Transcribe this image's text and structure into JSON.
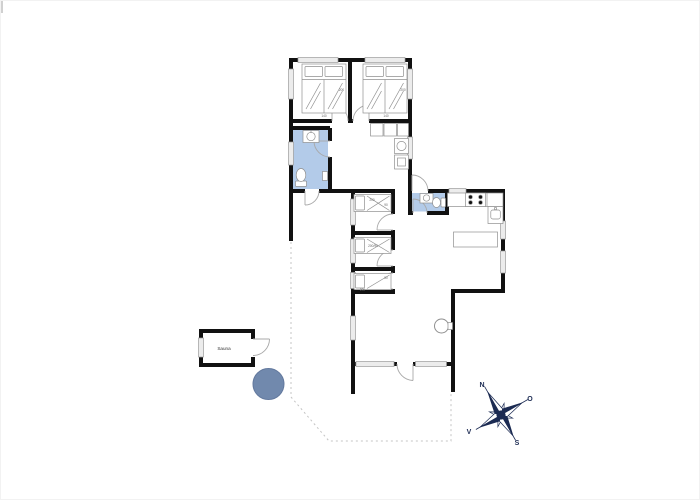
{
  "canvas": {
    "width": 700,
    "height": 500
  },
  "colors": {
    "wall": "#111111",
    "window_fill": "#ececec",
    "window_stroke": "#9c9c9c",
    "wet_room_fill": "#b3cbe9",
    "hot_tub_fill": "#7189ad",
    "hot_tub_stroke": "#63799e",
    "compass": "#1b2a52",
    "terrace_dash": "#c4c4c4",
    "furniture_stroke": "#8f8f8f",
    "door_stroke": "#a8a8a8",
    "dim_text": "#666666",
    "artifact": "#d0d0d0"
  },
  "labels": {
    "sauna": "Sauna"
  },
  "compass": {
    "north": "N",
    "east": "O",
    "south": "S",
    "west": "V"
  },
  "bed_dims": {
    "double_width": "140",
    "double_length": "200",
    "single": "200/90",
    "single_length": "200",
    "single_width": "90"
  }
}
